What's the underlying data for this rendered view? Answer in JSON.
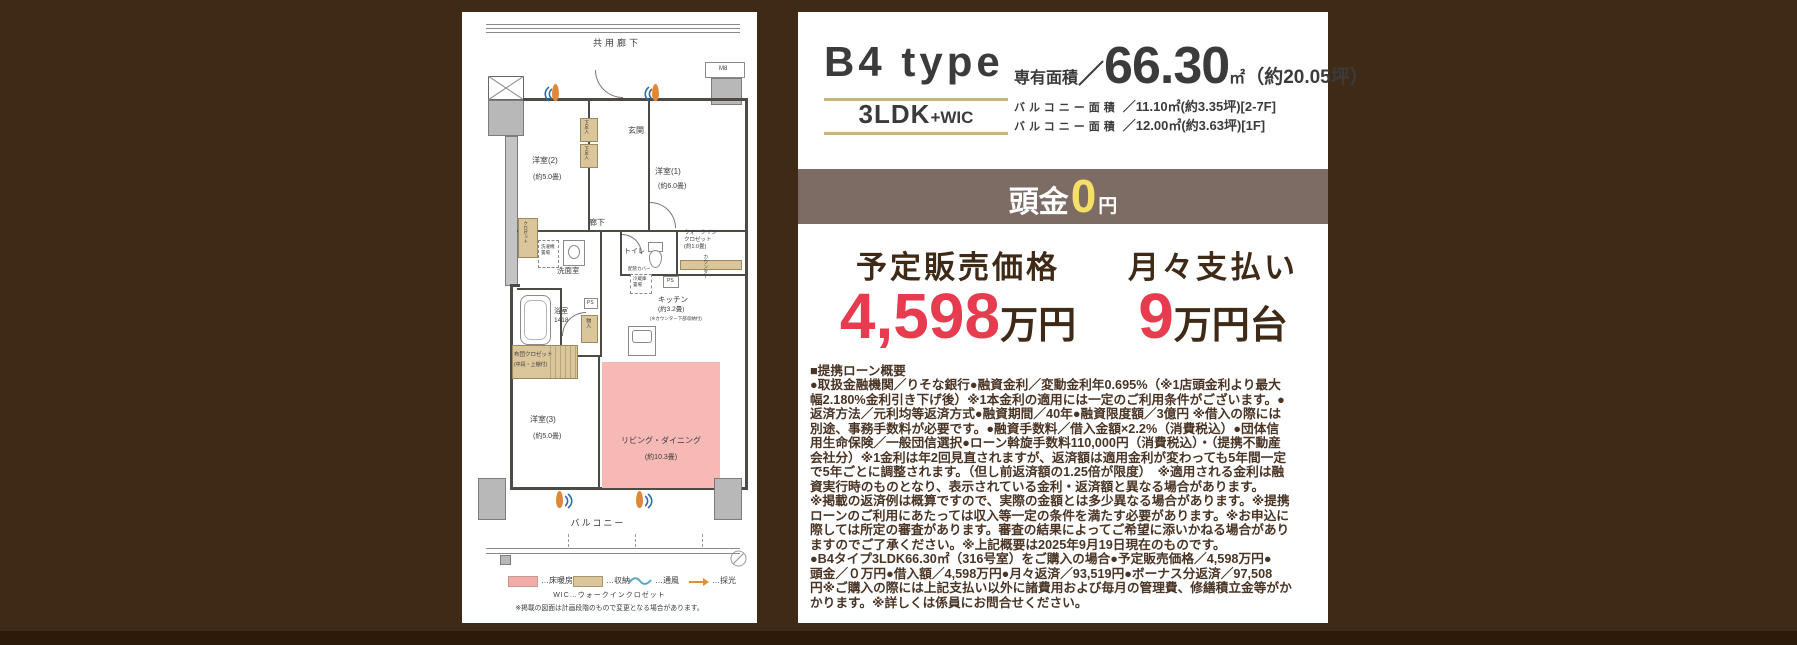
{
  "colors": {
    "background": "#3f2917",
    "bottom_strip": "#2c1a0b",
    "panel": "#ffffff",
    "band": "#7c6c63",
    "accent_yellow": "#f6df67",
    "accent_red": "#e73c4f",
    "dark_brown_text": "#3e2a17",
    "gold_rule": "#c9b284",
    "living_pink": "#f7b9b5",
    "storage_tan": "#dbc69b",
    "ventilation_blue": "#2c6ba0",
    "daylight_orange": "#df883a"
  },
  "info": {
    "type_name": "B4 type",
    "layout_main": "3LDK",
    "layout_sub": "+WIC",
    "area_label": "専有面積",
    "area_slash": "／",
    "area_value": "66.30",
    "area_unit": "㎡",
    "area_tsubo": "（約20.05坪）",
    "balcony1_label": "バルコニー面積",
    "balcony1_value": "／11.10㎡(約3.35坪)[2-7F]",
    "balcony2_label": "バルコニー面積",
    "balcony2_value": "／12.00㎡(約3.63坪)[1F]",
    "down_label": "頭金",
    "down_value": "0",
    "down_unit": "円",
    "price_label": "予定販売価格",
    "price_value": "4,598",
    "price_unit": "万円",
    "monthly_label": "月々支払い",
    "monthly_value": "9",
    "monthly_unit": "万円台",
    "loan_notes": "■提携ローン概要\n●取扱金融機関／りそな銀行●融資金利／変動金利年0.695%（※1店頭金利より最大\n幅2.180%金利引き下げ後）※1本金利の適用には一定のご利用条件がございます。●\n返済方法／元利均等返済方式●融資期間／40年●融資限度額／3億円 ※借入の際には\n別途、事務手数料が必要です。●融資手数料／借入金額×2.2%（消費税込）●団体信\n用生命保険／一般団信選択●ローン斡旋手数料110,000円（消費税込）・（提携不動産\n会社分）※1金利は年2回見直されますが、返済額は適用金利が変わっても5年間一定\nで5年ごとに調整されます。（但し前返済額の1.25倍が限度）　※適用される金利は融\n資実行時のものとなり、表示されている金利・返済額と異なる場合があります。\n※掲載の返済例は概算ですので、実際の金額とは多少異なる場合があります。※提携\nローンのご利用にあたっては収入等一定の条件を満たす必要があります。※お申込に\n際しては所定の審査があります。審査の結果によってご希望に添いかねる場合があり\nますのでご了承ください。※上記概要は2025年9月19日現在のものです。\n●B4タイプ3LDK66.30㎡（316号室）をご購入の場合●予定販売価格／4,598万円●\n頭金／０万円●借入額／4,598万円●月々返済／93,519円●ボーナス分返済／97,508\n円※ご購入の際には上記支払い以外に諸費用および毎月の管理費、修繕積立金等がか\nかります。※詳しくは係員にお問合せください。"
  },
  "floorplan": {
    "labels": {
      "common_corridor": "共用廊下",
      "m8": "M8",
      "genkan": "玄関",
      "shoe1": "下足入",
      "shoe2": "下足入",
      "western2": "洋室(2)",
      "western2_size": "(約5.0畳)",
      "western1": "洋室(1)",
      "western1_size": "(約6.0畳)",
      "wic": "ウォークイン\nクロゼット\n(約1.0畳)",
      "hallway": "廊下",
      "toilet": "トイレ",
      "pipe_cover": "配管カバー",
      "ps1": "PS",
      "ps2": "PS",
      "washroom": "洗面室",
      "laundry": "洗濯機\n置場",
      "closet2": "クロゼット",
      "bath": "浴室",
      "bath_size": "1418",
      "mono_storage": "物入",
      "kitchen": "キッチン",
      "kitchen_size": "(約3.2畳)",
      "kitchen_note": "(※カウンター下部収納付)",
      "counter": "カウンター",
      "fridge": "冷蔵庫\n置場",
      "futon1": "布団クロゼット",
      "futon2": "(中段・上棚付)",
      "western3": "洋室(3)",
      "western3_size": "(約5.0畳)",
      "living": "リビング・ダイニング",
      "living_size": "(約10.3畳)",
      "balcony": "バルコニー"
    },
    "legend": {
      "floor_heating": "…床暖房",
      "storage": "…収納",
      "ventilation": "…通風",
      "daylight": "…採光"
    },
    "wic_note": "WIC…ウォークインクロゼット",
    "disclaimer": "※掲載の図面は計画段階のもので変更となる場合があります。"
  }
}
